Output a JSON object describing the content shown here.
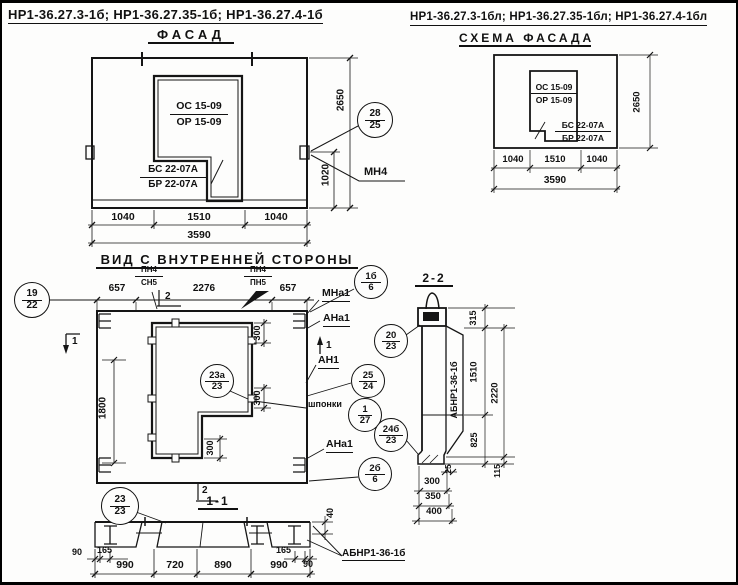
{
  "page": {
    "header_left": "НР1-36.27.3-1б; НР1-36.27.35-1б; НР1-36.27.4-1б",
    "header_right": "НР1-36.27.3-1бл; НР1-36.27.35-1бл; НР1-36.27.4-1бл"
  },
  "facade": {
    "title": "ФАСАД",
    "opening_mark": {
      "top": "ОС 15-09",
      "bottom": "ОР 15-09"
    },
    "block_mark": {
      "top": "БС 22-07А",
      "bottom": "БР 22-07А"
    },
    "dims": {
      "left": "1040",
      "mid": "1510",
      "right": "1040",
      "total": "3590",
      "height": "2650",
      "h1020": "1020"
    },
    "callout": {
      "top": "28",
      "bottom": "25"
    },
    "anchor": "МН4"
  },
  "schema": {
    "title": "СХЕМА ФАСАДА",
    "opening_mark": {
      "top": "ОС 15-09",
      "bottom": "ОР 15-09"
    },
    "block_mark": {
      "top": "БС 22-07А",
      "bottom": "БР 22-07А"
    },
    "dims": {
      "left": "1040",
      "mid": "1510",
      "right": "1040",
      "total": "3590",
      "height": "2650"
    }
  },
  "inner": {
    "title": "ВИД С ВНУТРЕННЕЙ СТОРОНЫ",
    "dims_top": [
      "657",
      "2276",
      "657"
    ],
    "pn_left": {
      "top": "ПН4",
      "bottom": "СН5"
    },
    "pn_right": {
      "top": "ПН4",
      "bottom": "ПН5"
    },
    "callout_19": {
      "top": "19",
      "bottom": "22"
    },
    "callout_1b": {
      "top": "1б",
      "bottom": "6"
    },
    "callout_23a": {
      "top": "23а",
      "bottom": "23"
    },
    "callout_25": {
      "top": "25",
      "bottom": "24"
    },
    "callout_1": {
      "top": "1",
      "bottom": "27"
    },
    "callout_20": {
      "top": "20",
      "bottom": "23"
    },
    "callout_24b": {
      "top": "24б",
      "bottom": "23"
    },
    "callout_2b": {
      "top": "2б",
      "bottom": "6"
    },
    "labels": {
      "mna1": "МНа1",
      "ana1": "АНа1",
      "an1": "АН1",
      "shponki": "шпонки",
      "ana1b": "АНа1"
    },
    "dim_300": "300",
    "dim_1800": "1800",
    "mark1": "1",
    "mark2": "2"
  },
  "sec11": {
    "title": "1-1",
    "callout": {
      "top": "23",
      "bottom": "23"
    },
    "dims": {
      "d90": "90",
      "d165": "165",
      "d990": "990",
      "d720": "720",
      "d890": "890",
      "d40": "40"
    },
    "label": "АБНР1-36-1б"
  },
  "sec22": {
    "title": "2-2",
    "panel_mark": "АБНР1-36-1б",
    "dims": {
      "d315": "315",
      "d1510": "1510",
      "d2220": "2220",
      "d825": "825",
      "d25": "25",
      "d115": "115",
      "d300": "300",
      "d350": "350",
      "d400": "400"
    }
  }
}
